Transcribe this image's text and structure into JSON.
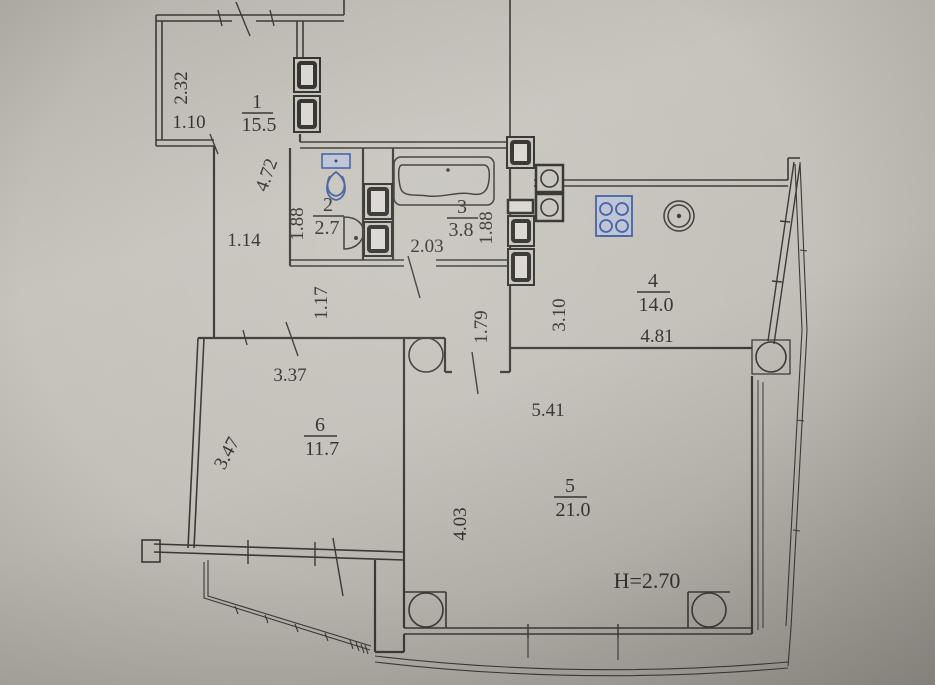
{
  "floorplan": {
    "rooms": [
      {
        "number": "1",
        "area": "15.5"
      },
      {
        "number": "2",
        "area": "2.7"
      },
      {
        "number": "3",
        "area": "3.8"
      },
      {
        "number": "4",
        "area": "14.0"
      },
      {
        "number": "5",
        "area": "21.0"
      },
      {
        "number": "6",
        "area": "11.7"
      }
    ],
    "dimensions": {
      "entry_side": "2.32",
      "entry_front": "1.10",
      "hall_wall": "4.72",
      "hall_passage": "1.14",
      "wc_side_left": "1.88",
      "bath_front": "2.03",
      "bath_side_right": "1.88",
      "corridor_lower": "1.17",
      "corridor_mid": "1.79",
      "kitchen_side": "3.10",
      "kitchen_front": "4.81",
      "room6_front": "3.37",
      "room6_side": "3.47",
      "room5_front": "5.41",
      "room5_side": "4.03"
    },
    "ceiling_height_note": "H=2.70",
    "colors": {
      "paper": "#c3c0b9",
      "ink": "#3b3833",
      "blue_pen": "#3d5ca4"
    }
  }
}
